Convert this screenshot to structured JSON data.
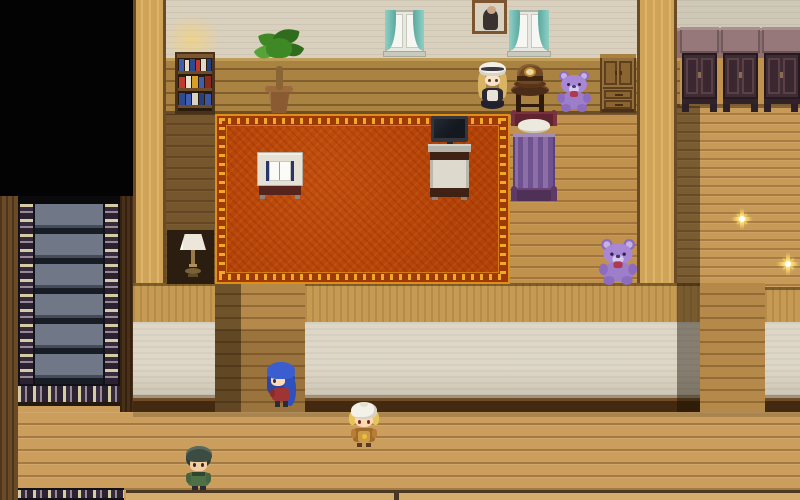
{
  "scene": {
    "type": "rpg-interior",
    "description": "Top-down pixel RPG house interior: bedroom with red carpet, wardrobe room, carpeted staircase and lower hallway",
    "rooms": [
      "bedroom-with-carpet",
      "wardrobe-room",
      "staircase",
      "hallway"
    ]
  },
  "colors": {
    "floor_wood": "#c1914e",
    "carpet_red": "#b8470d",
    "carpet_border_gold": "#e89a1c",
    "wall_cream": "#d9d0be",
    "wall_wood_band": "#aa8242",
    "stair_carpet_slate": "#707888",
    "wardrobe_mauve": "#96787a",
    "teddy_purple": "#a585d2",
    "bed_blanket_purple": "#7b5a94",
    "sparkle_gold": "#f5d060"
  },
  "characters": [
    {
      "name": "doll-gothic-blonde",
      "label": "Blonde doll in black dress"
    },
    {
      "name": "npc-blue-long-hair",
      "label": "Girl with long blue hair"
    },
    {
      "name": "npc-white-turban",
      "label": "Villager with white turban"
    },
    {
      "name": "npc-green-hair-man",
      "label": "Man with dark green hair"
    }
  ],
  "furniture": [
    {
      "name": "bookshelf"
    },
    {
      "name": "potted-plant"
    },
    {
      "name": "window",
      "count": 2
    },
    {
      "name": "framed-portrait"
    },
    {
      "name": "tv-on-desk"
    },
    {
      "name": "reading-table-open-book"
    },
    {
      "name": "purple-bed"
    },
    {
      "name": "hat-on-round-table"
    },
    {
      "name": "teddy-bear",
      "count": 2
    },
    {
      "name": "small-cabinet"
    },
    {
      "name": "wardrobe",
      "count": 3
    },
    {
      "name": "table-lamp"
    },
    {
      "name": "ornate-red-carpet"
    },
    {
      "name": "carpeted-staircase"
    }
  ],
  "effects": [
    {
      "name": "sparkle",
      "count": 2
    }
  ]
}
